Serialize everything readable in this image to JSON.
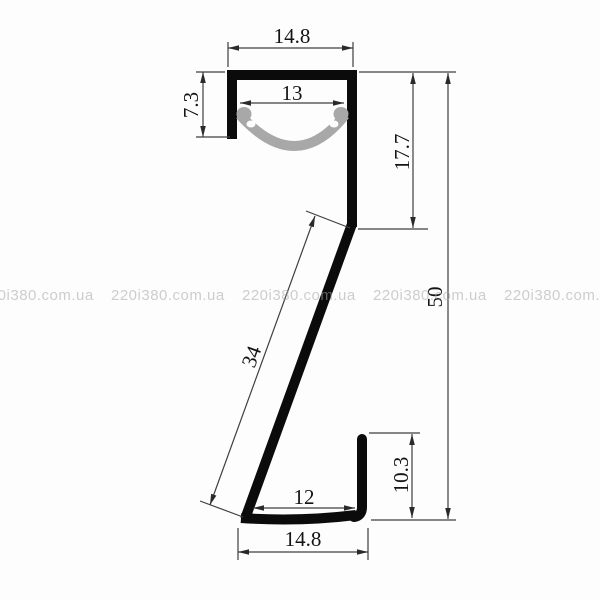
{
  "diagram": {
    "dimensions": {
      "top_outer_width": "14.8",
      "top_inner_width": "13",
      "top_channel_height": "7.3",
      "right_upper_height": "17.7",
      "overall_height": "50",
      "diagonal_length": "34",
      "bottom_inner_width": "12",
      "bottom_hook_height": "10.3",
      "bottom_outer_width": "14.8"
    },
    "colors": {
      "profile": "#0b0b0b",
      "diffuser_lens": "#a8a8a8",
      "dimension_lines": "#3f3f3f",
      "dimension_text": "#141414",
      "background": "#fdfdfd",
      "watermark": "#d2d2d2"
    }
  },
  "watermark": {
    "text": "220i380.com.ua"
  }
}
